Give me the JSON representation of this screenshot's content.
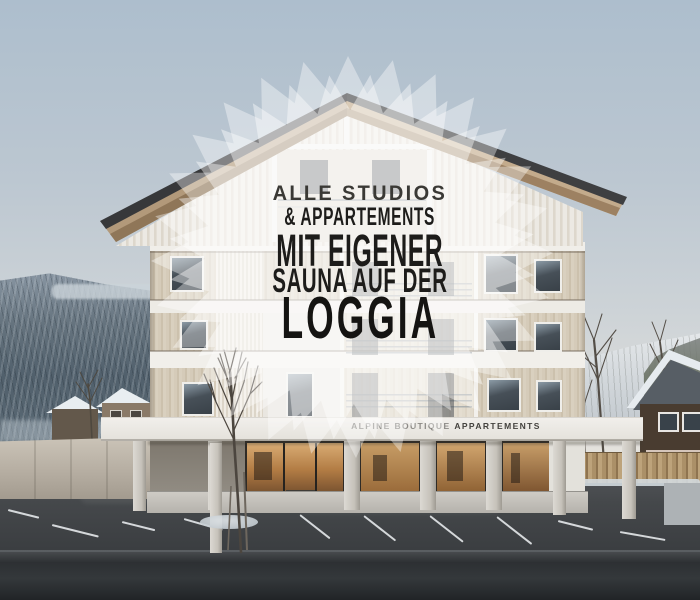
{
  "overlay_badge": {
    "lines": [
      "ALLE STUDIOS",
      "& APPARTEMENTS",
      "MIT EIGENER",
      "SAUNA AUF DER",
      "LOGGIA"
    ]
  },
  "building_sign": {
    "brand_light": "ALPINE BOUTIQUE",
    "brand_bold": "APPARTEMENTS"
  },
  "colors": {
    "overlay_text": "#1d1c1a",
    "starburst": "#ffffff",
    "sign_light": "#8b8985",
    "sign_dark": "#44423e",
    "sky_top": "#adbecd",
    "facade_wood": "#d2c8b6",
    "storefront_glow": "#c79d66",
    "asphalt": "#3a3d40"
  }
}
